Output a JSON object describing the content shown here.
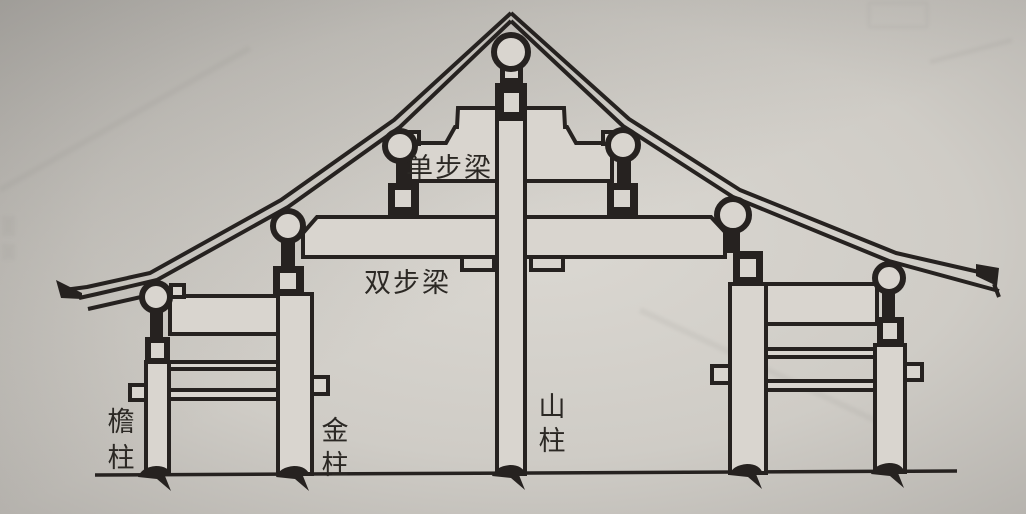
{
  "diagram": {
    "figure_type": "traditional-chinese-timber-frame-cross-section",
    "labels": {
      "single_step_beam": "单步梁",
      "double_step_beam": "双步梁",
      "eave_column": "檐柱",
      "golden_column": "金柱",
      "ridge_column": "山柱"
    },
    "colors": {
      "ink": "#262220",
      "paper": "#cfccc6",
      "paper_light": "#d9d5cf"
    }
  }
}
